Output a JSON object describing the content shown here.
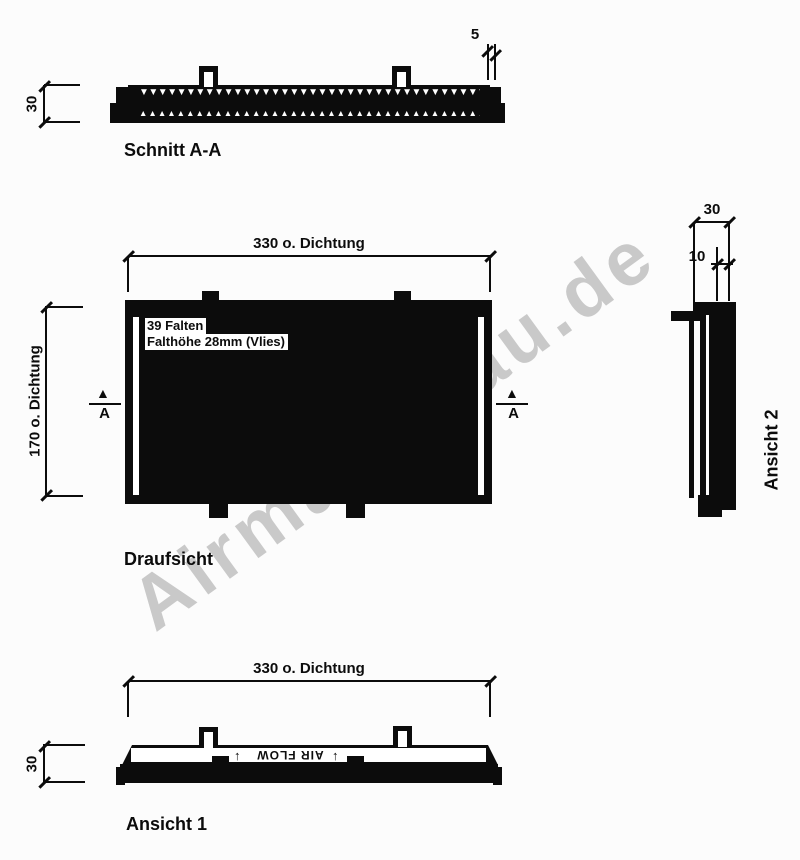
{
  "watermark": {
    "text": "Airmaticbau.de"
  },
  "sections": {
    "schnitt": {
      "title": "Schnitt A-A",
      "height_dim": "30",
      "gasket_dim": "5"
    },
    "draufsicht": {
      "title": "Draufsicht",
      "width_dim": "330 o. Dichtung",
      "height_dim": "170 o. Dichtung",
      "note_line1": "39 Falten",
      "note_line2": "Falthöhe 28mm (Vlies)",
      "marker_letter": "A",
      "marker_glyph": "▲"
    },
    "ansicht1": {
      "title": "Ansicht 1",
      "width_dim": "330 o. Dichtung",
      "height_dim": "30",
      "flow_label": "AIR FLOW",
      "arrow_glyph": "↑"
    },
    "ansicht2": {
      "title": "Ansicht 2",
      "width_dim": "30",
      "inner_dim": "10"
    }
  },
  "pleats": {
    "top_glyph": "▼",
    "bottom_glyph": "▲",
    "count": 38
  },
  "colors": {
    "ink": "#0c0c0c",
    "watermark": "#c9c9c9",
    "background": "#fcfcfc"
  }
}
